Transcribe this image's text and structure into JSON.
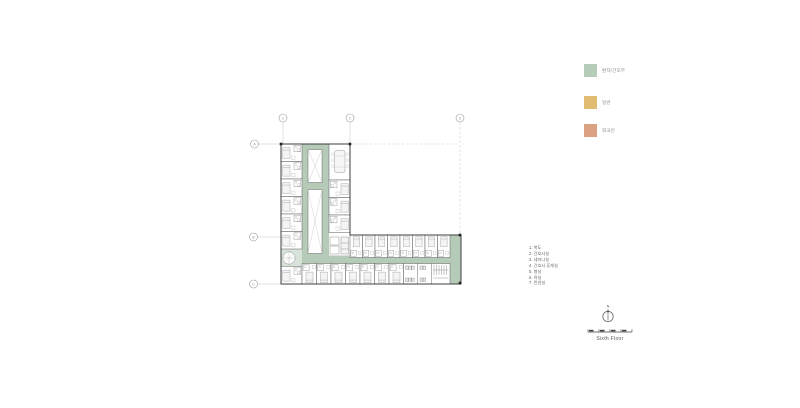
{
  "page": {
    "background": "#ffffff"
  },
  "legend": {
    "items": [
      {
        "label": "환자/간호부",
        "color": "#b7ccb9"
      },
      {
        "label": "일반",
        "color": "#e2bc72"
      },
      {
        "label": "외국인",
        "color": "#dba183"
      }
    ]
  },
  "notes": {
    "items": [
      "1. 복도",
      "2. 간호사실",
      "3. 세미나실",
      "4. 간호사 휴게실",
      "5. 병실",
      "6. 욕실",
      "7. 린넨실"
    ]
  },
  "plan": {
    "corridor_color": "#b6cab8",
    "wall_color": "#3d3d3d"
  },
  "grid": {
    "top": [
      "1",
      "2",
      "3"
    ],
    "left": [
      "A",
      "B",
      "C"
    ]
  },
  "compass": {
    "label": "N"
  },
  "title": {
    "floor_label": "Sixth Floor"
  }
}
